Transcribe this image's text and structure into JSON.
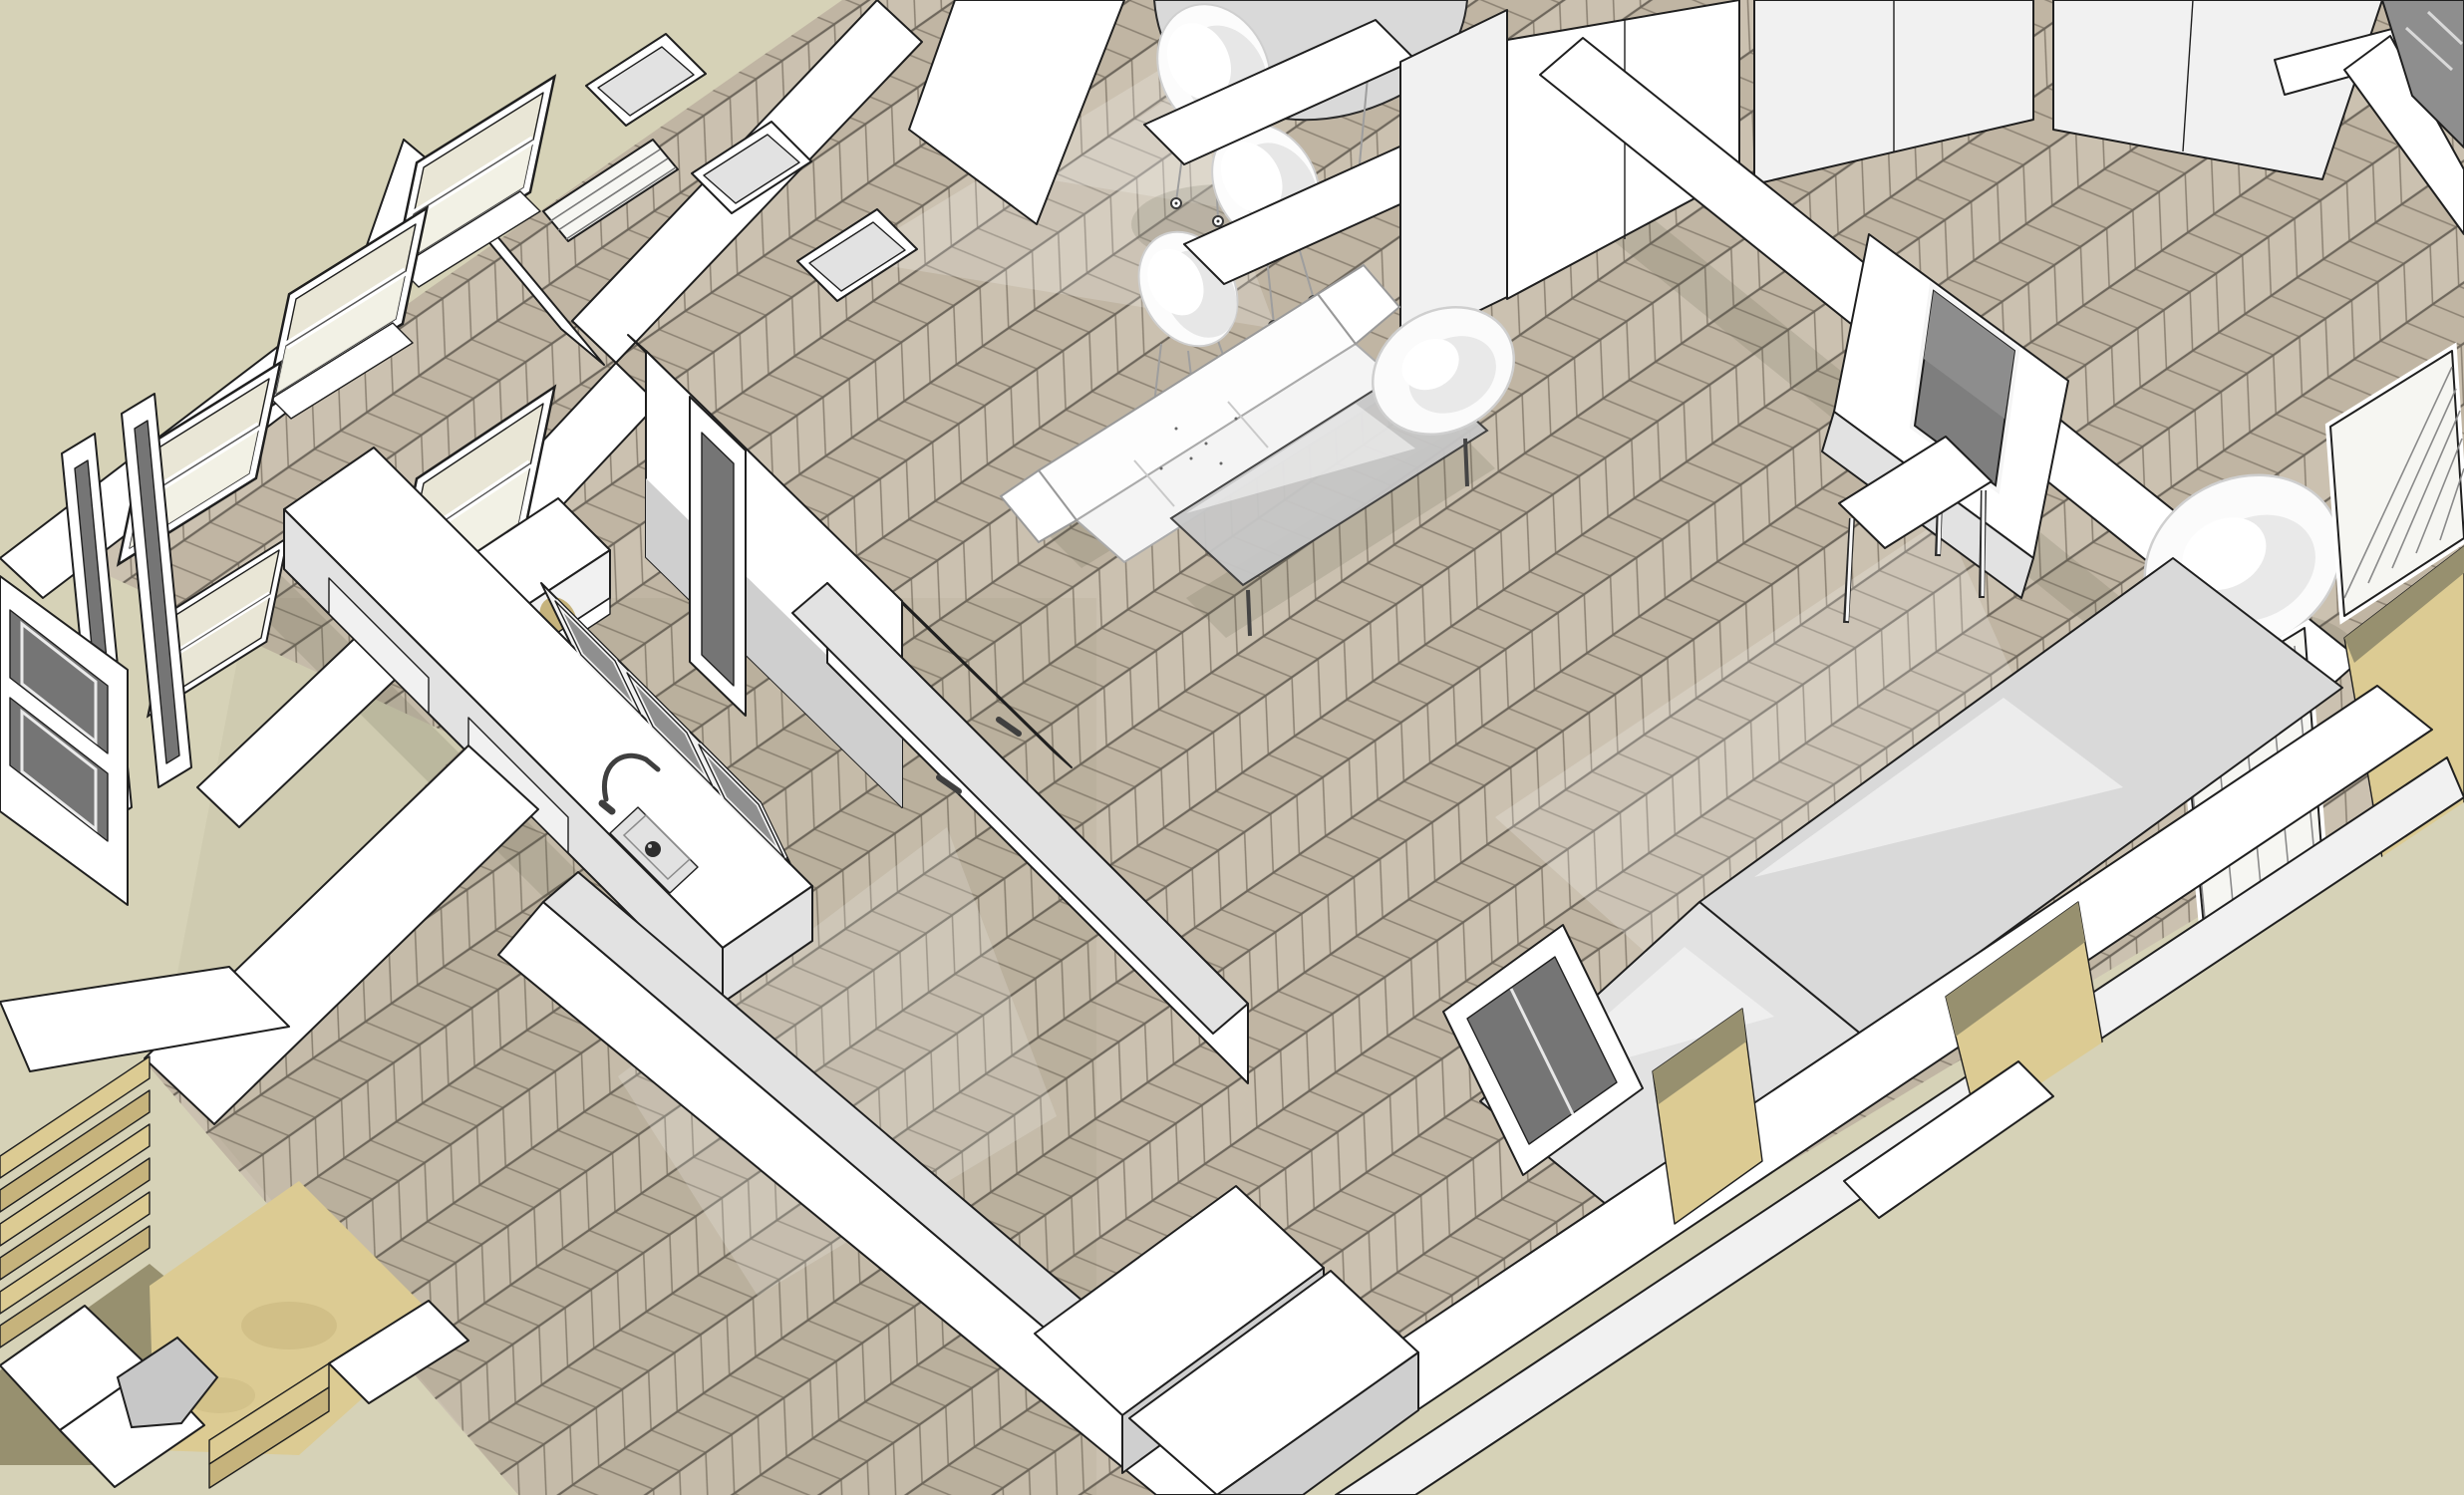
{
  "meta": {
    "app": "3d-interior-model-viewport",
    "description": "Monochrome SketchUp-style aerial axonometric view of an apartment interior: white walls and furniture with black edge lines, chevron parquet floor, khaki background void, kitchen island with sink, dining chairs, sofa, glass coffee table, TV media wall, tan staircase and balconies",
    "visible_text": ""
  },
  "palette": {
    "void_bg": "#d6d2b7",
    "floor_a": "#cbc1b0",
    "floor_b": "#c0b5a3",
    "floor_line": "#8d8374",
    "floor_seam": "#6e675c",
    "wall_white": "#ffffff",
    "wall_light": "#f1f1f1",
    "wall_mid": "#e2e2e2",
    "wall_shade": "#cfcfcf",
    "wall_gray": "#d9d9d9",
    "outline": "#1f1f1f",
    "soft_line": "#9e9e9e",
    "glass_pale": "#e9e6d6",
    "glass_bright": "#f6f6f2",
    "panel_dark": "#757575",
    "panel_glass": "#8f8f8f",
    "tv_screen": "#7e7e7e",
    "tv_screen_light": "#8d8d8d",
    "wood_tan": "#dccb93",
    "wood_tan_mid": "#c6b37c",
    "wood_tan_dark": "#97906f",
    "metal_dark": "#3f3f3f",
    "shadow": "rgba(90,84,68,0.16)",
    "sheen": "rgba(255,255,255,0.2)"
  },
  "scene": {
    "objects": [
      {
        "name": "exterior-void",
        "label": "Khaki background outside model"
      },
      {
        "name": "parquet-floor",
        "label": "Chevron parquet floor"
      },
      {
        "name": "left-wall-windows",
        "label": "Left wall with sash windows"
      },
      {
        "name": "kitchen-window",
        "label": "Kitchen sash window"
      },
      {
        "name": "radiator-bench",
        "label": "Radiator cover bench"
      },
      {
        "name": "french-door",
        "label": "Open french door"
      },
      {
        "name": "kitchen-island",
        "label": "Kitchen island with bar glass doors"
      },
      {
        "name": "island-sink",
        "label": "Island sink with drain"
      },
      {
        "name": "island-faucet",
        "label": "Gooseneck faucet"
      },
      {
        "name": "shelving-top",
        "label": "Open shelving seen from above"
      },
      {
        "name": "central-wall",
        "label": "Central partition wall"
      },
      {
        "name": "interior-door",
        "label": "Interior door leaf with glass"
      },
      {
        "name": "partition-wall",
        "label": "Partition wall with door hardware"
      },
      {
        "name": "dining-table",
        "label": "Round dining table"
      },
      {
        "name": "dining-chair",
        "label": "White shell dining chair"
      },
      {
        "name": "wardrobe",
        "label": "Wardrobe cabinets"
      },
      {
        "name": "media-wall",
        "label": "Media wall"
      },
      {
        "name": "tv-screen",
        "label": "Wall-mounted TV"
      },
      {
        "name": "sofa",
        "label": "White sofa"
      },
      {
        "name": "coffee-table",
        "label": "Glass coffee table"
      },
      {
        "name": "console-table",
        "label": "White console table"
      },
      {
        "name": "armchair",
        "label": "Rounded armchair"
      },
      {
        "name": "balcony-window",
        "label": "Balcony french window"
      },
      {
        "name": "corner-window-dark",
        "label": "Dark corner window"
      },
      {
        "name": "balcony-floor",
        "label": "Tan balcony floor"
      },
      {
        "name": "exterior-wall-band",
        "label": "Outer wall band"
      },
      {
        "name": "glossy-wall",
        "label": "Glossy gray wall face"
      },
      {
        "name": "hall-wall",
        "label": "Hallway wall"
      },
      {
        "name": "storage-boxes",
        "label": "White storage furniture"
      },
      {
        "name": "glazed-door",
        "label": "Glazed dark door"
      },
      {
        "name": "staircase",
        "label": "Tan staircase"
      },
      {
        "name": "stair-landing",
        "label": "Stair landing"
      },
      {
        "name": "stair-railing",
        "label": "White stair railing"
      },
      {
        "name": "sideboard-dark-panels",
        "label": "Sideboard with dark glass panels"
      }
    ]
  }
}
